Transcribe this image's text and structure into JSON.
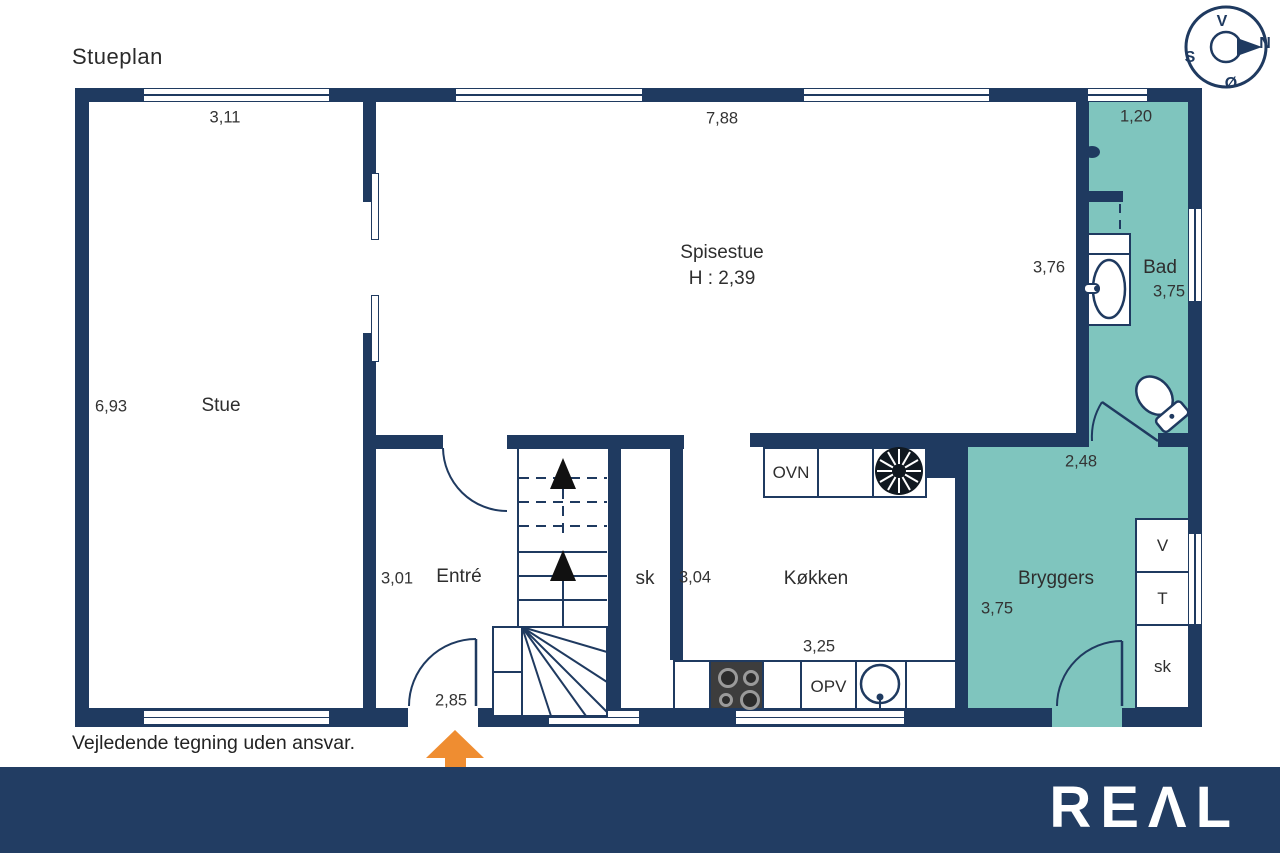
{
  "title": "Stueplan",
  "disclaimer": "Vejledende tegning uden ansvar.",
  "brand": {
    "logo": "REΛL"
  },
  "compass": {
    "top": "V",
    "right": "N",
    "left": "S",
    "bottom": "Ø"
  },
  "rooms": {
    "stue": {
      "label": "Stue",
      "width": "3,11",
      "length": "6,93"
    },
    "spisestue": {
      "label": "Spisestue",
      "ceiling_height": "H : 2,39",
      "width": "7,88",
      "depth": "3,76"
    },
    "entre": {
      "label": "Entré",
      "width": "3,01",
      "door_width": "2,85"
    },
    "kokken": {
      "label": "Køkken",
      "depth": "3,04",
      "width": "3,25"
    },
    "bad": {
      "label": "Bad",
      "width": "1,20",
      "length": "3,75"
    },
    "bryggers": {
      "label": "Bryggers",
      "width": "2,48",
      "length": "3,75"
    }
  },
  "fixtures": {
    "oven": "OVN",
    "dishwasher": "OPV",
    "washer": "V",
    "dryer": "T",
    "hall_closet": "sk",
    "bryggers_closet": "sk"
  },
  "colors": {
    "wall": "#1f3a60",
    "wet_room": "#7fc5be",
    "entrance_arrow": "#ef8d31",
    "footer_bar": "#223d63",
    "text": "#2e2e2e"
  }
}
